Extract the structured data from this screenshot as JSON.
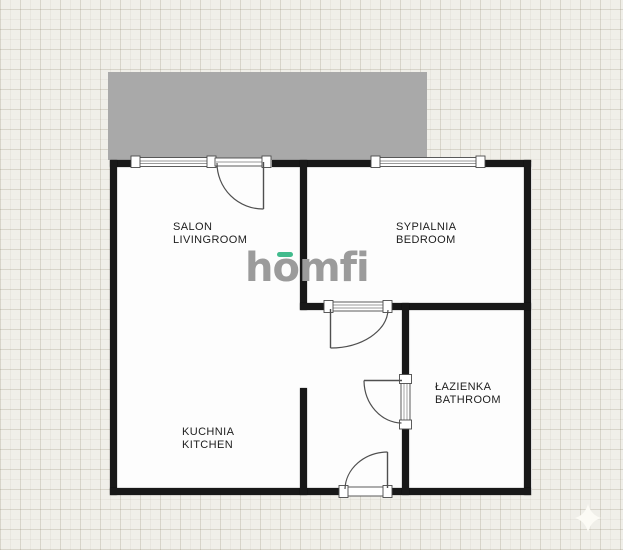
{
  "watermark": {
    "text": "homfi",
    "color": "#9b9b9b",
    "accent_color": "#42bb8d"
  },
  "colors": {
    "wall": "#181818",
    "floor": "#fdfdfd",
    "balcony": "#a9a9a9",
    "background": "#f0efe9",
    "label_text": "#1d1d1d"
  },
  "rooms": [
    {
      "id": "livingroom",
      "name_pl": "SALON",
      "name_en": "LIVINGROOM"
    },
    {
      "id": "bedroom",
      "name_pl": "SYPIALNIA",
      "name_en": "BEDROOM"
    },
    {
      "id": "bathroom",
      "name_pl": "ŁAZIENKA",
      "name_en": "BATHROOM"
    },
    {
      "id": "kitchen",
      "name_pl": "KUCHNIA",
      "name_en": "KITCHEN"
    }
  ],
  "icons": {
    "sparkle": "four-pointed-star"
  }
}
